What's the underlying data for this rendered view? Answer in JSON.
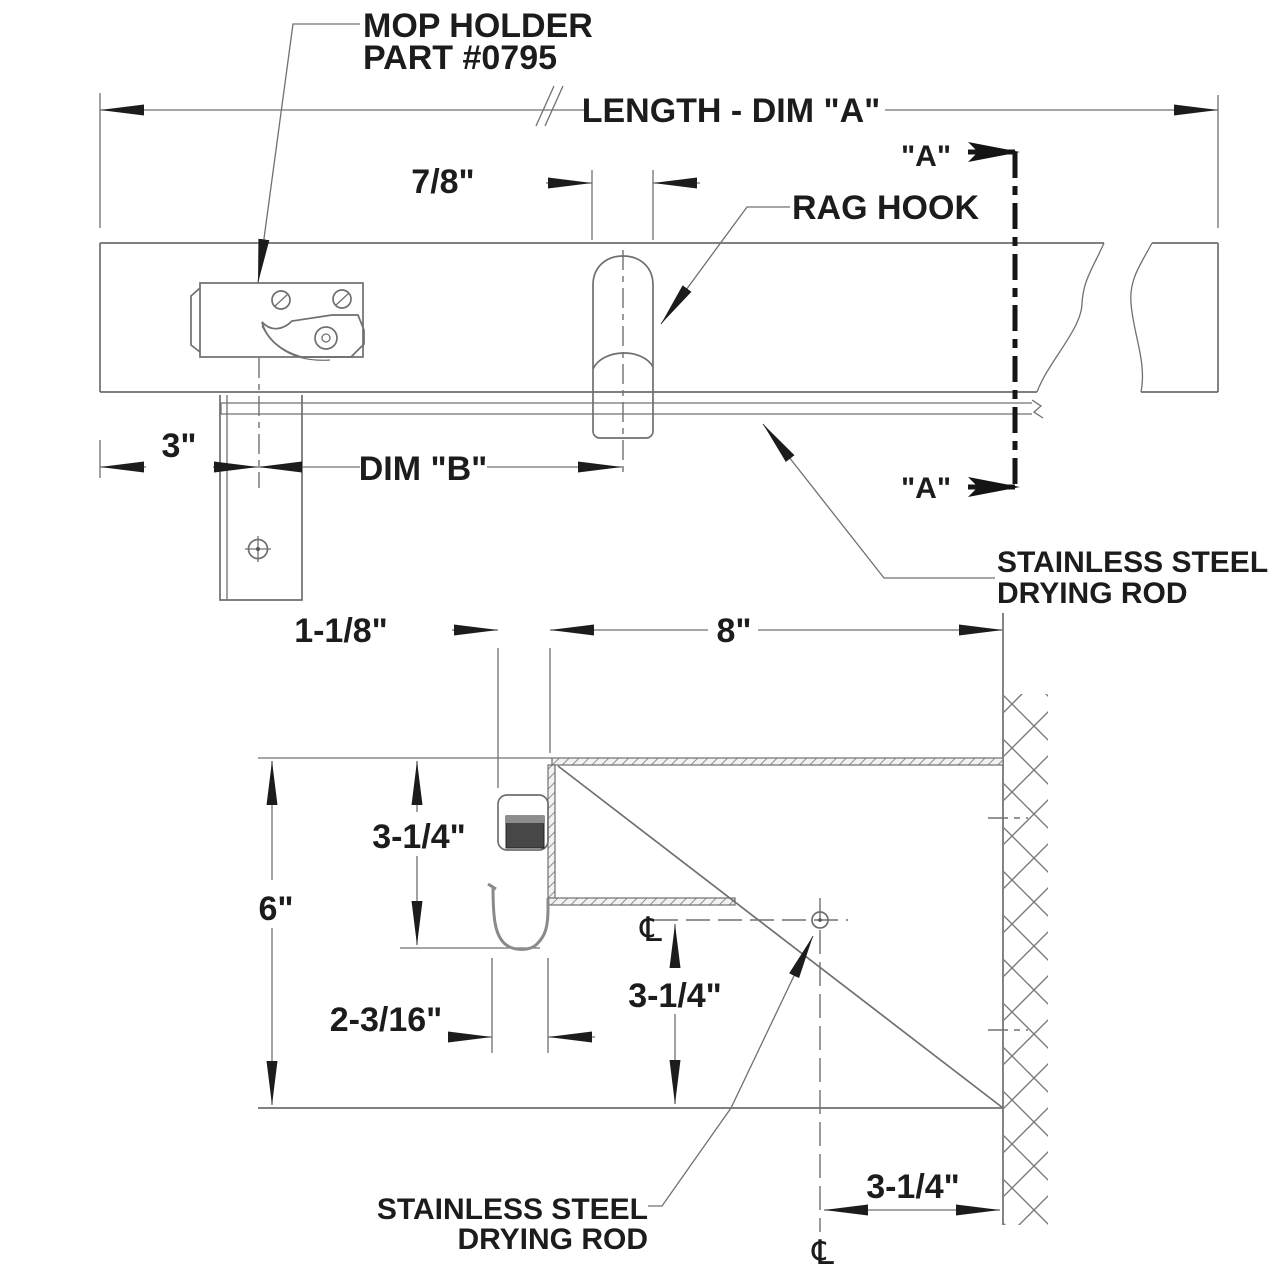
{
  "drawing": {
    "front_view": {
      "part_callout": {
        "line1": "MOP HOLDER",
        "line2": "PART #0795"
      },
      "length_dim": "LENGTH - DIM \"A\"",
      "hook_width_dim": "7/8\"",
      "rag_hook_label": "RAG HOOK",
      "section_marker": "\"A\"",
      "left_offset_dim": "3\"",
      "spacing_dim": "DIM \"B\"",
      "rod_label": {
        "line1": "STAINLESS STEEL",
        "line2": "DRYING ROD"
      }
    },
    "section_view": {
      "holder_depth_dim": "1-1/8\"",
      "shelf_depth_dim": "8\"",
      "holder_drop_dim": "3-1/4\"",
      "overall_height_dim": "6\"",
      "hook_depth_dim": "2-3/16\"",
      "rod_drop_dim": "3-1/4\"",
      "rod_wall_offset_dim": "3-1/4\"",
      "rod_label": {
        "line1": "STAINLESS STEEL",
        "line2": "DRYING ROD"
      },
      "centerline_symbol": "℄"
    }
  }
}
